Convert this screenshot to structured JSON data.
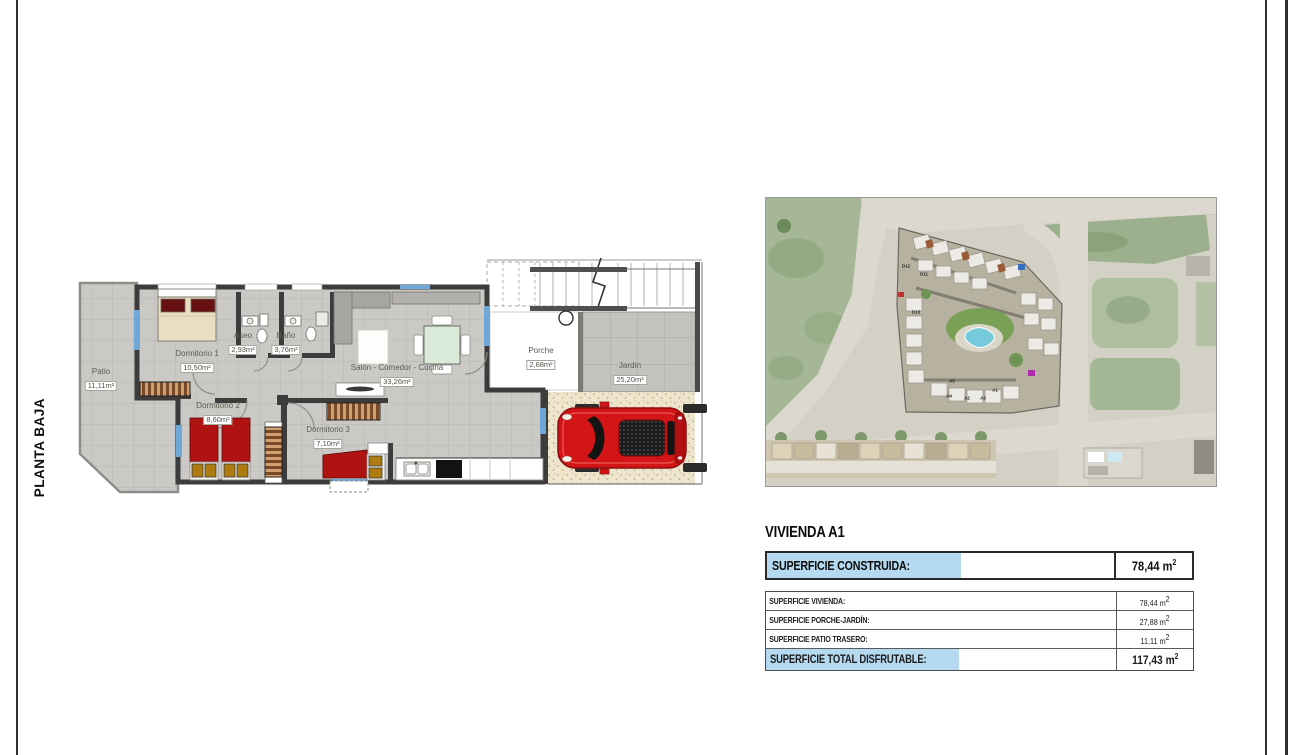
{
  "side_label": "PLANTA BAJA",
  "plan": {
    "rooms": [
      {
        "name": "Patio",
        "area": "11,11m²"
      },
      {
        "name": "Dormitorio 1",
        "area": "10,50m²"
      },
      {
        "name": "Aseo",
        "area": "2,93m²"
      },
      {
        "name": "Baño",
        "area": "3,76m²"
      },
      {
        "name": "Salón - Comedor - Cocina",
        "area": "33,26m²"
      },
      {
        "name": "Dormitorio 2",
        "area": "8,60m²"
      },
      {
        "name": "Dormitorio 3",
        "area": "7,10m²"
      },
      {
        "name": "Porche",
        "area": "2,68m²"
      },
      {
        "name": "Jardín",
        "area": "25,20m²"
      }
    ]
  },
  "map": {
    "labels": [
      {
        "t": "D12",
        "x": 140,
        "y": 68
      },
      {
        "t": "D11",
        "x": 158,
        "y": 76
      },
      {
        "t": "D13",
        "x": 150,
        "y": 114
      },
      {
        "t": "A5",
        "x": 186,
        "y": 183
      },
      {
        "t": "A4",
        "x": 183,
        "y": 198
      },
      {
        "t": "A2",
        "x": 201,
        "y": 200
      },
      {
        "t": "A3",
        "x": 217,
        "y": 200
      },
      {
        "t": "A1",
        "x": 229,
        "y": 192
      }
    ]
  },
  "details": {
    "title": "VIVIENDA A1",
    "summary": {
      "label": "SUPERFICIE CONSTRUIDA:",
      "value": "78,44",
      "unit": "m",
      "exp": "2"
    },
    "rows": [
      {
        "label": "SUPERFICIE VIVIENDA:",
        "value": "78,44",
        "unit": "m",
        "exp": "2"
      },
      {
        "label": "SUPERFICIE PORCHE-JARDÍN:",
        "value": "27,88",
        "unit": "m",
        "exp": "2"
      },
      {
        "label": "SUPERFICIE PATIO TRASERO:",
        "value": "11,11",
        "unit": "m",
        "exp": "2"
      }
    ],
    "total": {
      "label": "SUPERFICIE TOTAL DISFRUTABLE:",
      "value": "117,43",
      "unit": "m",
      "exp": "2"
    }
  },
  "colors": {
    "highlight_blue": "#b5d9f0",
    "wall_dark": "#3c3c3c",
    "floor_gray": "#cbc9c5",
    "car_red": "#d31518",
    "pool_blue": "#77c9dc"
  }
}
